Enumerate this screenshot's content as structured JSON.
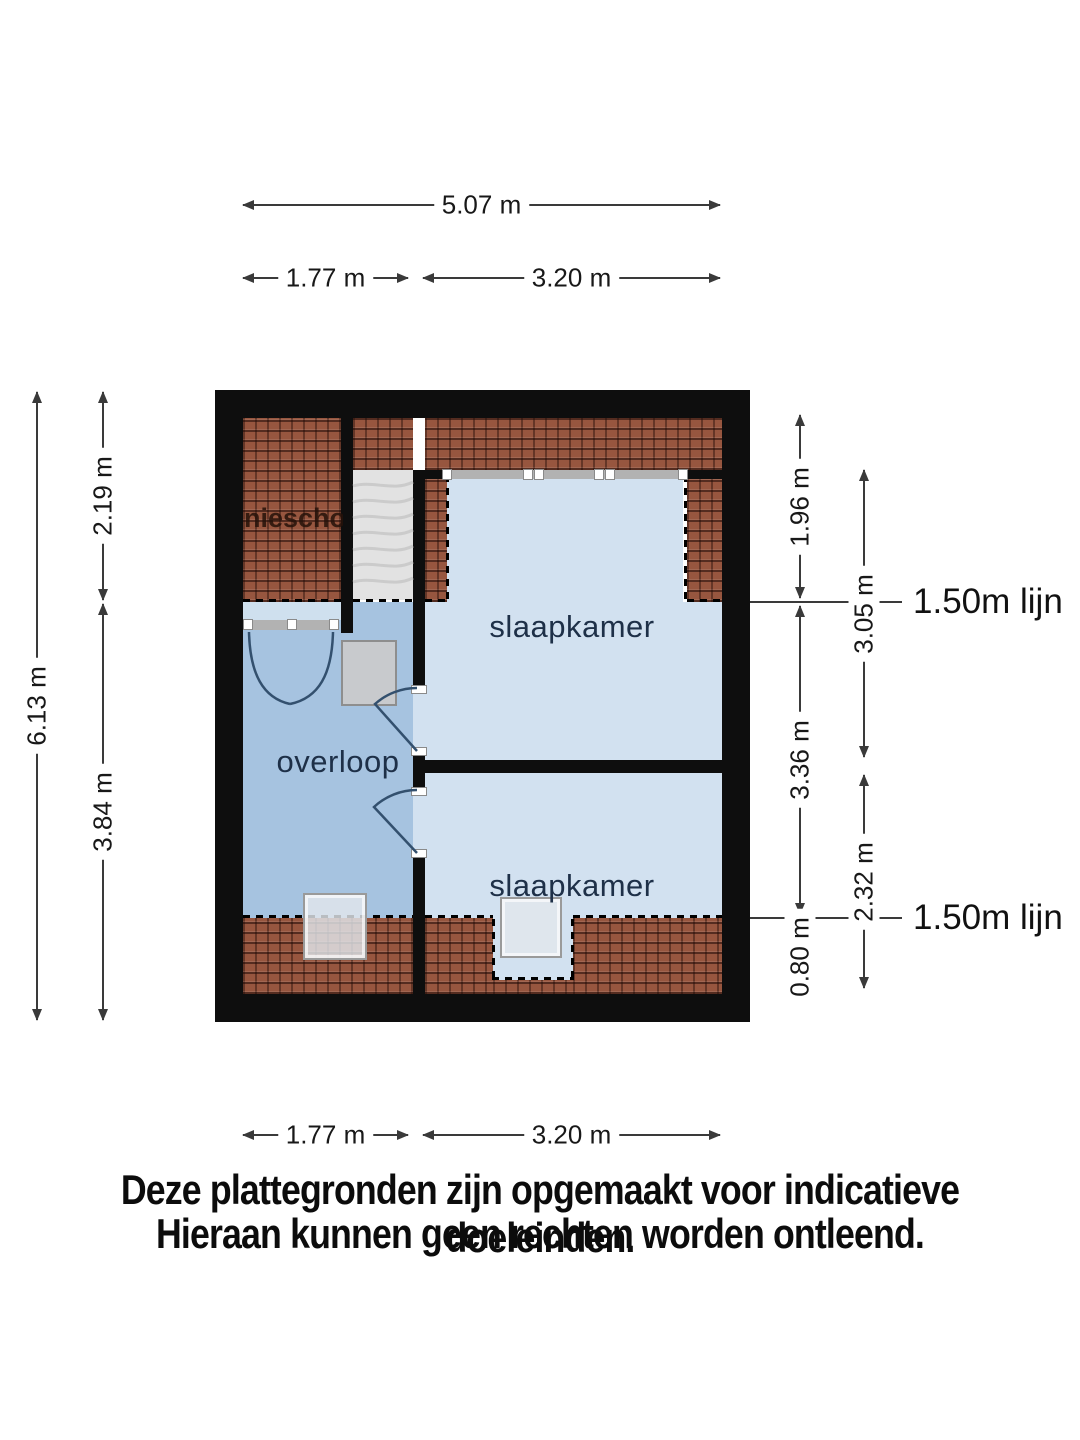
{
  "floorplan": {
    "rooms": [
      {
        "id": "overloop",
        "label": "overloop"
      },
      {
        "id": "slaapkamer-top",
        "label": "slaapkamer"
      },
      {
        "id": "slaapkamer-bottom",
        "label": "slaapkamer"
      },
      {
        "id": "knee-wall",
        "label": "niescho"
      }
    ],
    "height_lines": [
      {
        "label": "1.50m lijn"
      },
      {
        "label": "1.50m lijn"
      }
    ],
    "dimensions": {
      "top_total": "5.07 m",
      "top_left": "1.77 m",
      "top_right": "3.20 m",
      "bottom_left": "1.77 m",
      "bottom_right": "3.20 m",
      "left_total": "6.13 m",
      "left_upper": "2.19 m",
      "left_lower": "3.84 m",
      "right_upper": "1.96 m",
      "right_middle": "3.36 m",
      "right_lower": "0.80 m",
      "right_inner_upper": "3.05 m",
      "right_inner_lower": "2.32 m"
    },
    "colors": {
      "wall": "#0e0e0e",
      "roof_tiles": "#97563f",
      "bedroom_fill": "#d2e1f0",
      "landing_fill": "#a6c3e0"
    }
  },
  "disclaimer": {
    "line1": "Deze plattegronden zijn opgemaakt voor indicatieve doeleinden.",
    "line2": "Hieraan kunnen geen rechten worden ontleend."
  }
}
